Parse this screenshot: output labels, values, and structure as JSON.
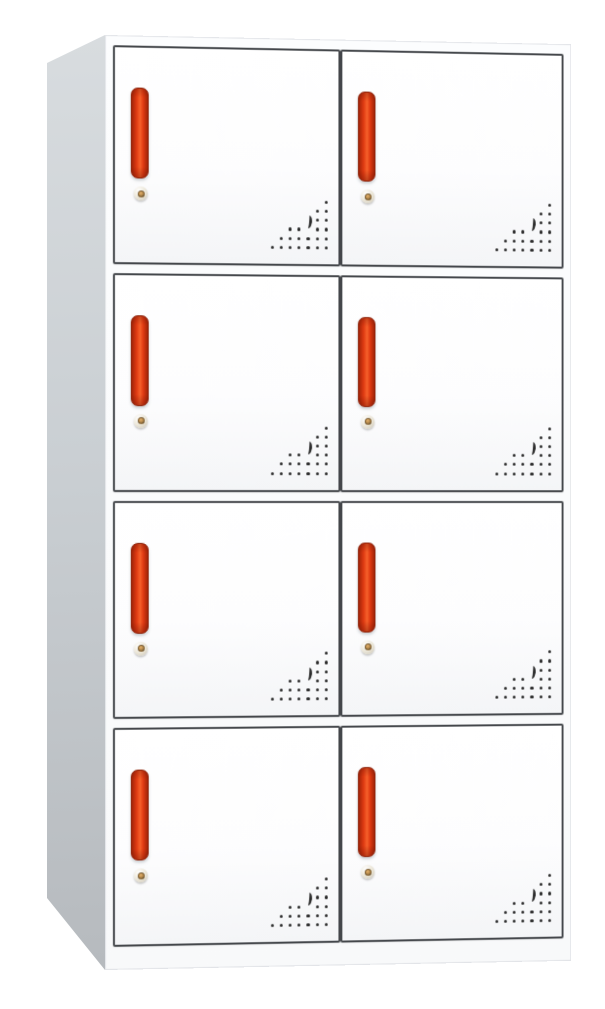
{
  "scene": {
    "description": "Product photo of a white steel locker cabinet with eight compartment doors (2 columns x 4 rows). Each door has a vertical red recessed handle, a small round keyhole lock, and a triangular pattern of ventilation holes with a crescent-shaped cutout in its lower-right corner. The cabinet is viewed slightly from the left, showing a gray side panel."
  },
  "cabinet": {
    "columns": 2,
    "rows": 4,
    "door_count": 8,
    "doors": [
      {
        "id": 1,
        "row": 1,
        "col": 1
      },
      {
        "id": 2,
        "row": 1,
        "col": 2
      },
      {
        "id": 3,
        "row": 2,
        "col": 1
      },
      {
        "id": 4,
        "row": 2,
        "col": 2
      },
      {
        "id": 5,
        "row": 3,
        "col": 1
      },
      {
        "id": 6,
        "row": 3,
        "col": 2
      },
      {
        "id": 7,
        "row": 4,
        "col": 1
      },
      {
        "id": 8,
        "row": 4,
        "col": 2
      }
    ],
    "door_features": {
      "handle": "vertical red recessed handle",
      "lock": "round cam lock with keyhole",
      "vent": "triangular perforated vent with crescent cutout"
    },
    "vent_pattern": {
      "spacing": 9.2,
      "dot_size": 3.2,
      "rows_cols_from_right": [
        [
          0
        ],
        [
          0,
          1
        ],
        [
          0,
          1
        ],
        [
          0,
          1,
          3,
          4
        ],
        [
          0,
          1,
          2,
          3,
          4,
          5
        ],
        [
          0,
          1,
          2,
          3,
          4,
          5,
          6
        ]
      ],
      "crescent": {
        "col_from_right": 2,
        "row_from_top": 2
      }
    },
    "colors": {
      "page_background": "#ffffff",
      "side_panel_light": "#d8dcdf",
      "side_panel_mid": "#cacfd3",
      "side_panel_dark": "#b6babe",
      "door_face": "#fdfdfe",
      "door_face_shade": "#f4f5f7",
      "door_border": "#44474b",
      "handle_dark_red": "#a32408",
      "handle_red": "#df3a12",
      "handle_orange": "#f6602a",
      "handle_outline": "#8c1f06",
      "lock_rim": "#ece7d9",
      "lock_shadow": "#c8c2b3",
      "lock_center": "#b18648",
      "lock_keyhole": "#5d4a2e",
      "vent_dot": "#2a2a2a"
    }
  }
}
